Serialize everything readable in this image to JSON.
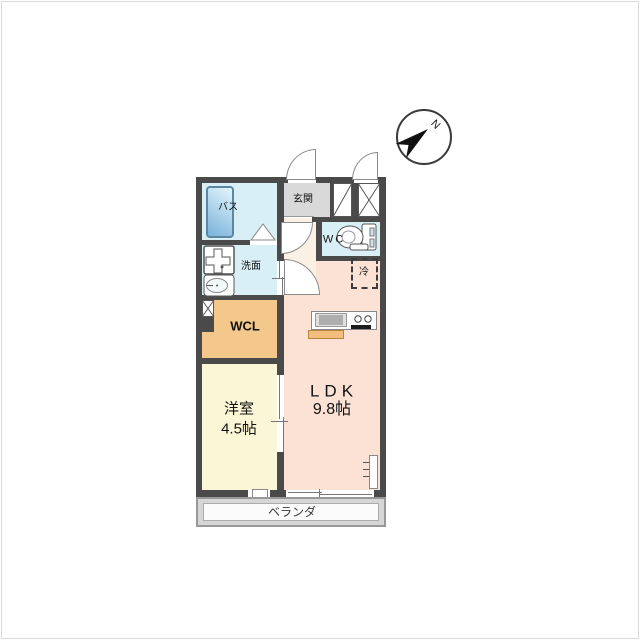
{
  "floor_plan": {
    "compass": {
      "label": "N"
    },
    "rooms": {
      "bath": {
        "label": "バス"
      },
      "entrance": {
        "label": "玄関"
      },
      "wc": {
        "label": "WC"
      },
      "washroom": {
        "label": "洗面"
      },
      "wcl": {
        "label": "WCL"
      },
      "western_room": {
        "label": "洋室",
        "size": "4.5帖"
      },
      "ldk": {
        "label": "LDK",
        "size": "9.8帖"
      },
      "refrigerator": {
        "label": "冷"
      },
      "balcony": {
        "label": "ベランダ"
      }
    },
    "colors": {
      "wall": "#4a4a4a",
      "wet_area_blue": "#d8eff6",
      "entrance_gray": "#d9d9d9",
      "hallway_cream": "#faf0e4",
      "ldk_pink": "#fbe2d5",
      "western_room_yellow": "#fbf7d6",
      "wcl_orange": "#f4c78a",
      "balcony_gray": "#d6d6d6",
      "bathtub_blue": "#7db5dc"
    },
    "fixtures": [
      "bathtub",
      "washing-machine-pan",
      "vanity-sink",
      "toilet",
      "kitchen-counter",
      "gas-stove",
      "refrigerator-space",
      "shoe-cabinet",
      "pipe-shaft",
      "sliding-doors",
      "swing-doors"
    ]
  }
}
